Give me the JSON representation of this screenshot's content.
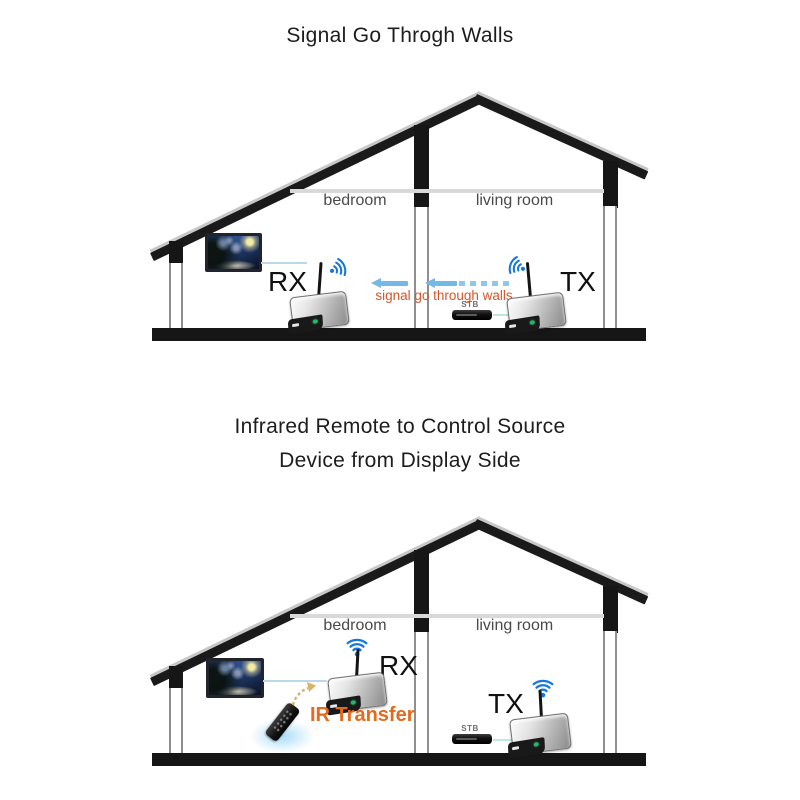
{
  "colors": {
    "structure_black": "#161616",
    "wifi_blue": "#1677e0",
    "arrow_blue": "#74b9e6",
    "signal_text_orange": "#d4562a",
    "ir_text_orange": "#e56a1a",
    "ir_beam_gold": "#d8b266",
    "room_label_gray": "#4a4a4a",
    "ceiling_gray": "#d9d9d9"
  },
  "diagram1": {
    "title": "Signal Go Throgh Walls",
    "room_left": "bedroom",
    "room_right": "living room",
    "rx_label": "RX",
    "tx_label": "TX",
    "signal_text": "signal go through walls",
    "stb_label": "STB"
  },
  "diagram2": {
    "title_line1": "Infrared Remote to Control Source",
    "title_line2": "Device from Display Side",
    "room_left": "bedroom",
    "room_right": "living room",
    "rx_label": "RX",
    "tx_label": "TX",
    "ir_text": "IR Transfer",
    "stb_label": "STB"
  }
}
